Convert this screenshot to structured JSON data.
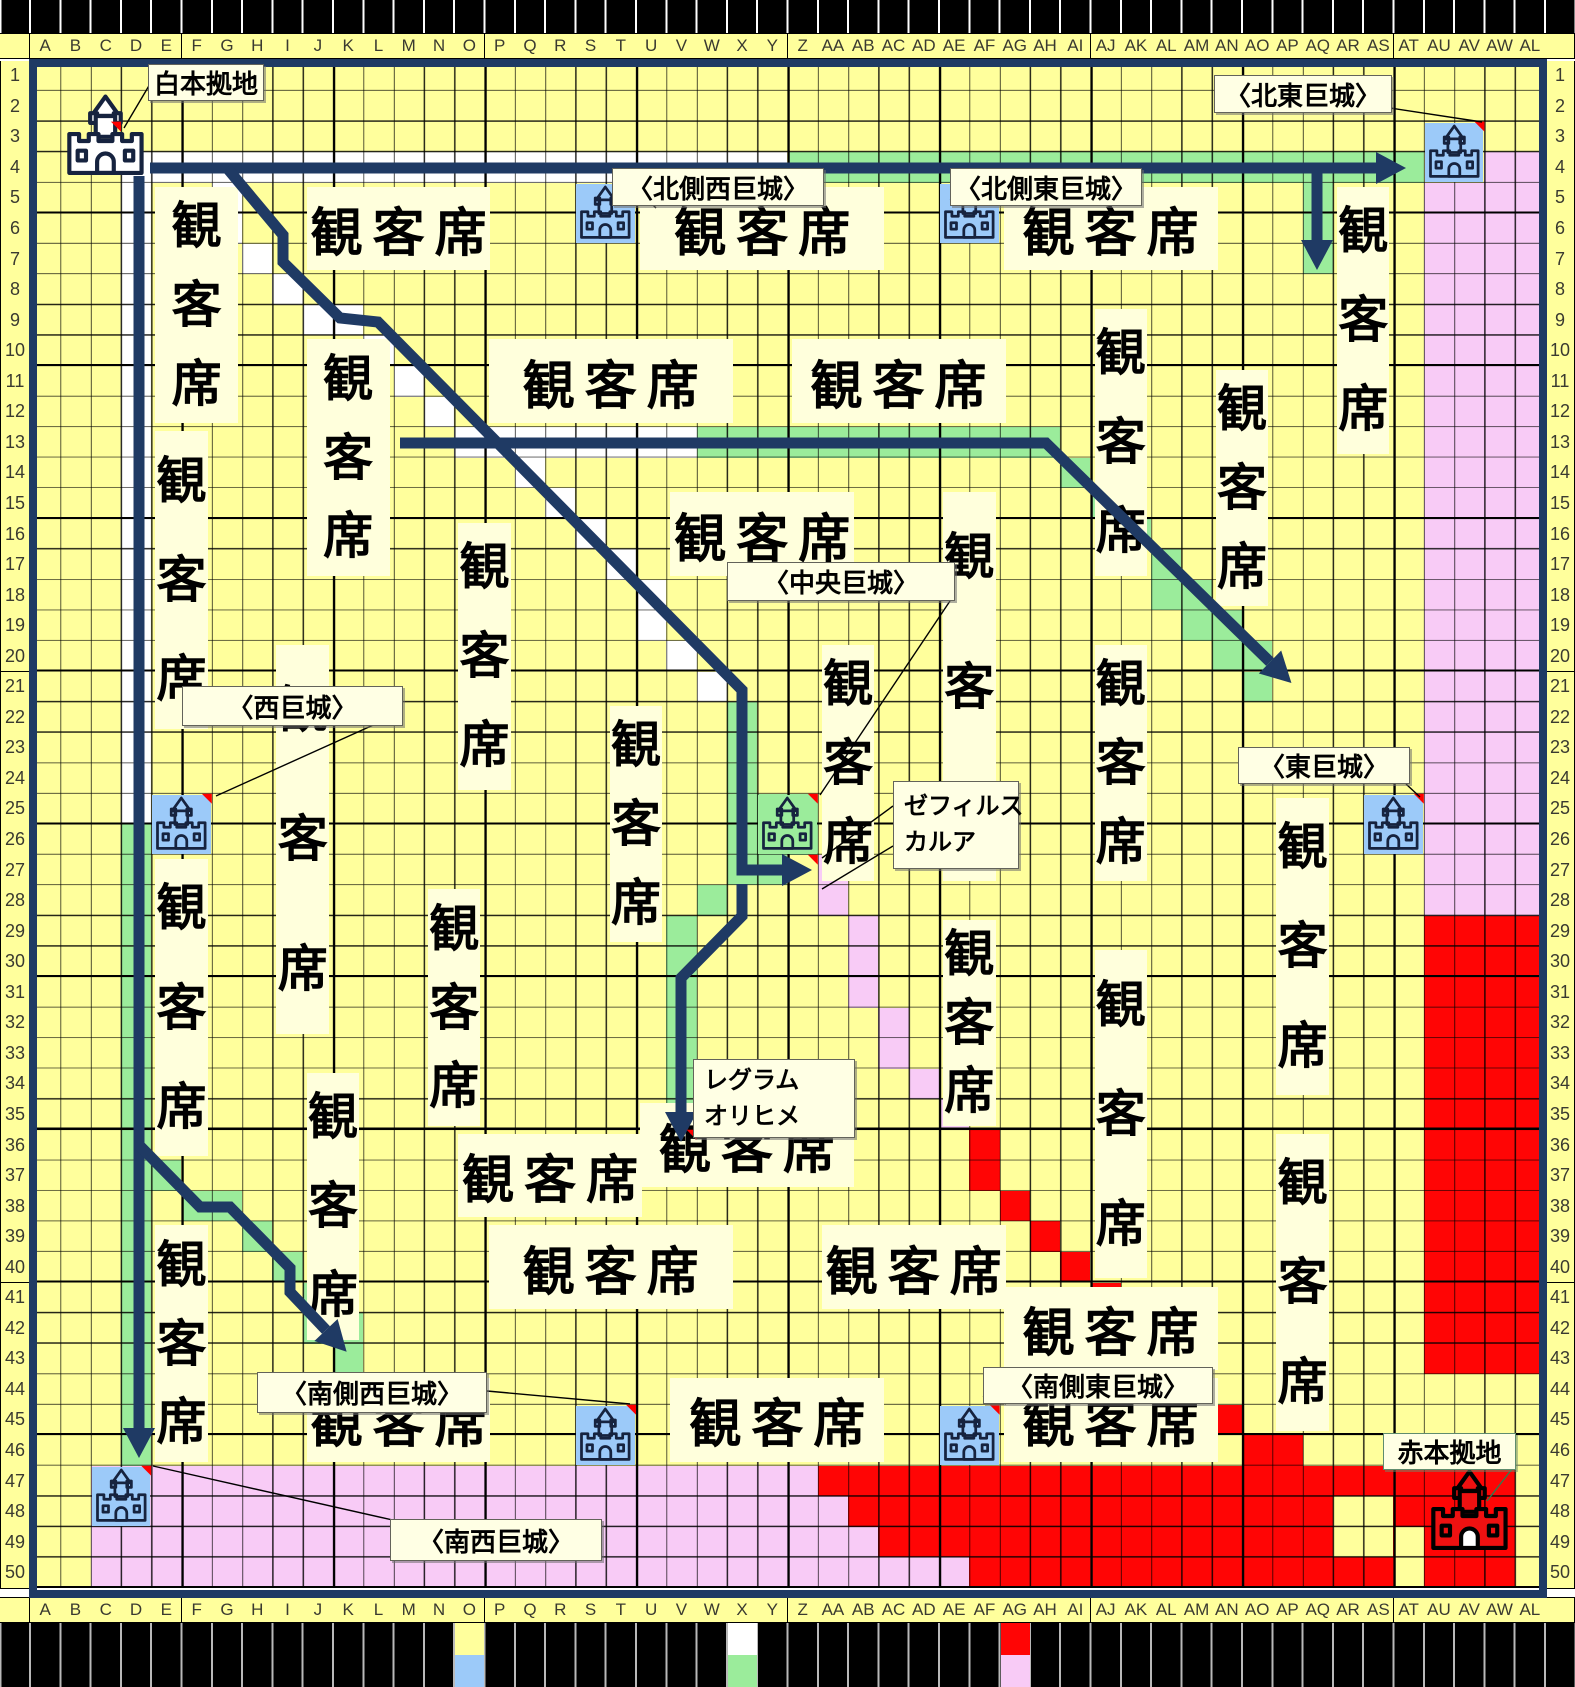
{
  "map_title": "合戦マップ(50×50)",
  "colors": {
    "yellow": "#FFFF9C",
    "white": "#FFFFFF",
    "green": "#9BEC9B",
    "pink": "#F8CBF6",
    "red": "#FF0505",
    "blue": "#9CCAF9",
    "cream": "#FFFFDC",
    "navy": "#1F3A64",
    "black": "#000000",
    "marker": "#FF0000",
    "pointer_green": "#2E7D4F"
  },
  "grid": {
    "origin_x": 30,
    "origin_y": 60.5,
    "cell_w": 30.3,
    "cell_h": 30.55,
    "col_count": 50,
    "row_count": 50,
    "col_headers": [
      "A",
      "B",
      "C",
      "D",
      "E",
      "F",
      "G",
      "H",
      "I",
      "J",
      "K",
      "L",
      "M",
      "N",
      "O",
      "P",
      "Q",
      "R",
      "S",
      "T",
      "U",
      "V",
      "W",
      "X",
      "Y",
      "Z",
      "AA",
      "AB",
      "AC",
      "AD",
      "AE",
      "AF",
      "AG",
      "AH",
      "AI",
      "AJ",
      "AK",
      "AL",
      "AM",
      "AN",
      "AO",
      "AP",
      "AQ",
      "AR",
      "AS",
      "AT",
      "AU",
      "AV",
      "AW",
      "AL"
    ],
    "row_numbers": [
      1,
      2,
      3,
      4,
      5,
      6,
      7,
      8,
      9,
      10,
      11,
      12,
      13,
      14,
      15,
      16,
      17,
      18,
      19,
      20,
      21,
      22,
      23,
      24,
      25,
      26,
      27,
      28,
      29,
      30,
      31,
      32,
      33,
      34,
      35,
      36,
      37,
      38,
      39,
      40,
      41,
      42,
      43,
      44,
      45,
      46,
      47,
      48,
      49,
      50
    ]
  },
  "regions": {
    "rects": [
      {
        "color": "pink",
        "c1": 46,
        "r1": 4,
        "c2": 49,
        "r2": 27
      },
      {
        "color": "pink",
        "c1": 48,
        "r1": 3,
        "c2": 49,
        "r2": 3
      },
      {
        "color": "red",
        "c1": 46,
        "r1": 28,
        "c2": 49,
        "r2": 42
      },
      {
        "color": "pink",
        "c1": 2,
        "r1": 46,
        "c2": 25,
        "r2": 49
      },
      {
        "color": "red",
        "c1": 26,
        "r1": 46,
        "c2": 48,
        "r2": 49
      },
      {
        "color": "white",
        "c1": 3,
        "r1": 3,
        "c2": 24,
        "r2": 3
      },
      {
        "color": "white",
        "c1": 3,
        "r1": 4,
        "c2": 3,
        "r2": 24
      },
      {
        "color": "white",
        "c1": 14,
        "r1": 12,
        "c2": 21,
        "r2": 12
      },
      {
        "color": "green",
        "c1": 25,
        "r1": 3,
        "c2": 45,
        "r2": 3
      },
      {
        "color": "green",
        "c1": 42,
        "r1": 4,
        "c2": 42,
        "r2": 6
      },
      {
        "color": "green",
        "c1": 22,
        "r1": 12,
        "c2": 33,
        "r2": 12
      },
      {
        "color": "green",
        "c1": 3,
        "r1": 25,
        "c2": 3,
        "r2": 45
      },
      {
        "color": "green",
        "c1": 23,
        "r1": 21,
        "c2": 23,
        "r2": 26
      },
      {
        "color": "green",
        "c1": 21,
        "r1": 28,
        "c2": 21,
        "r2": 35
      },
      {
        "color": "green",
        "c1": 24,
        "r1": 24,
        "c2": 25,
        "r2": 25
      }
    ],
    "cells": {
      "white": [
        [
          6,
          4
        ],
        [
          6,
          5
        ],
        [
          7,
          6
        ],
        [
          8,
          7
        ],
        [
          9,
          8
        ],
        [
          10,
          8
        ],
        [
          11,
          9
        ],
        [
          12,
          10
        ],
        [
          13,
          11
        ],
        [
          16,
          13
        ],
        [
          17,
          14
        ],
        [
          18,
          15
        ],
        [
          19,
          16
        ],
        [
          20,
          17
        ],
        [
          20,
          18
        ],
        [
          21,
          19
        ],
        [
          22,
          20
        ]
      ],
      "green": [
        [
          24,
          26
        ],
        [
          22,
          27
        ],
        [
          34,
          13
        ],
        [
          35,
          14
        ],
        [
          36,
          15
        ],
        [
          37,
          16
        ],
        [
          37,
          17
        ],
        [
          38,
          17
        ],
        [
          38,
          18
        ],
        [
          39,
          18
        ],
        [
          39,
          19
        ],
        [
          40,
          19
        ],
        [
          40,
          20
        ],
        [
          4,
          36
        ],
        [
          5,
          37
        ],
        [
          6,
          37
        ],
        [
          7,
          38
        ],
        [
          8,
          39
        ],
        [
          9,
          40
        ],
        [
          9,
          41
        ],
        [
          10,
          41
        ],
        [
          10,
          42
        ]
      ],
      "pink": [
        [
          26,
          26
        ],
        [
          26,
          27
        ],
        [
          27,
          28
        ],
        [
          27,
          29
        ],
        [
          27,
          30
        ],
        [
          28,
          31
        ],
        [
          28,
          32
        ],
        [
          29,
          33
        ],
        [
          30,
          34
        ],
        [
          26,
          47
        ],
        [
          26,
          48
        ],
        [
          27,
          48
        ],
        [
          26,
          49
        ],
        [
          27,
          49
        ],
        [
          28,
          49
        ],
        [
          29,
          49
        ],
        [
          30,
          49
        ]
      ],
      "red": [
        [
          31,
          35
        ],
        [
          31,
          36
        ],
        [
          32,
          37
        ],
        [
          33,
          38
        ],
        [
          34,
          39
        ],
        [
          35,
          40
        ],
        [
          36,
          41
        ],
        [
          37,
          42
        ],
        [
          38,
          43
        ],
        [
          39,
          44
        ],
        [
          40,
          45
        ],
        [
          41,
          45
        ],
        [
          42,
          46
        ]
      ],
      "yellow": [
        [
          43,
          47
        ],
        [
          44,
          47
        ],
        [
          43,
          48
        ],
        [
          44,
          48
        ],
        [
          45,
          48
        ],
        [
          45,
          49
        ],
        [
          49,
          46
        ],
        [
          49,
          47
        ],
        [
          49,
          48
        ],
        [
          49,
          49
        ]
      ]
    }
  },
  "spectator_blocks": {
    "text": "観客席",
    "blocks": [
      {
        "c1": 4,
        "r1": 4,
        "c2": 6,
        "r2": 11,
        "o": "v"
      },
      {
        "c1": 9,
        "r1": 4,
        "c2": 14,
        "r2": 6,
        "o": "h"
      },
      {
        "c1": 20,
        "r1": 4,
        "c2": 27,
        "r2": 6,
        "o": "h"
      },
      {
        "c1": 32,
        "r1": 4,
        "c2": 38,
        "r2": 6,
        "o": "h"
      },
      {
        "c1": 43,
        "r1": 4,
        "c2": 44,
        "r2": 12,
        "o": "v"
      },
      {
        "c1": 9,
        "r1": 9,
        "c2": 11,
        "r2": 16,
        "o": "v"
      },
      {
        "c1": 15,
        "r1": 9,
        "c2": 22,
        "r2": 11,
        "o": "h"
      },
      {
        "c1": 25,
        "r1": 9,
        "c2": 31,
        "r2": 11,
        "o": "h"
      },
      {
        "c1": 35,
        "r1": 8,
        "c2": 36,
        "r2": 16,
        "o": "v"
      },
      {
        "c1": 4,
        "r1": 12,
        "c2": 5,
        "r2": 21,
        "o": "v"
      },
      {
        "c1": 14,
        "r1": 15,
        "c2": 15,
        "r2": 23,
        "o": "v"
      },
      {
        "c1": 21,
        "r1": 14,
        "c2": 26,
        "r2": 16,
        "o": "h"
      },
      {
        "c1": 30,
        "r1": 14,
        "c2": 31,
        "r2": 26,
        "o": "v"
      },
      {
        "c1": 39,
        "r1": 10,
        "c2": 40,
        "r2": 17,
        "o": "v"
      },
      {
        "c1": 19,
        "r1": 21,
        "c2": 20,
        "r2": 28,
        "o": "v"
      },
      {
        "c1": 26,
        "r1": 19,
        "c2": 27,
        "r2": 26,
        "o": "v"
      },
      {
        "c1": 35,
        "r1": 19,
        "c2": 36,
        "r2": 26,
        "o": "v"
      },
      {
        "c1": 8,
        "r1": 19,
        "c2": 9,
        "r2": 31,
        "o": "v"
      },
      {
        "c1": 4,
        "r1": 26,
        "c2": 5,
        "r2": 35,
        "o": "v"
      },
      {
        "c1": 13,
        "r1": 27,
        "c2": 14,
        "r2": 34,
        "o": "v"
      },
      {
        "c1": 30,
        "r1": 28,
        "c2": 31,
        "r2": 34,
        "o": "v"
      },
      {
        "c1": 41,
        "r1": 24,
        "c2": 42,
        "r2": 33,
        "o": "v"
      },
      {
        "c1": 4,
        "r1": 38,
        "c2": 5,
        "r2": 45,
        "o": "v"
      },
      {
        "c1": 9,
        "r1": 33,
        "c2": 10,
        "r2": 41,
        "o": "v"
      },
      {
        "c1": 35,
        "r1": 29,
        "c2": 36,
        "r2": 39,
        "o": "v"
      },
      {
        "c1": 41,
        "r1": 35,
        "c2": 42,
        "r2": 44,
        "o": "v"
      },
      {
        "c1": 20,
        "r1": 34,
        "c2": 26,
        "r2": 36,
        "o": "h"
      },
      {
        "c1": 14,
        "r1": 35,
        "c2": 19,
        "r2": 37,
        "o": "h"
      },
      {
        "c1": 26,
        "r1": 38,
        "c2": 31,
        "r2": 40,
        "o": "h"
      },
      {
        "c1": 15,
        "r1": 38,
        "c2": 22,
        "r2": 40,
        "o": "h"
      },
      {
        "c1": 32,
        "r1": 40,
        "c2": 38,
        "r2": 42,
        "o": "h"
      },
      {
        "c1": 9,
        "r1": 43,
        "c2": 14,
        "r2": 45,
        "o": "h"
      },
      {
        "c1": 21,
        "r1": 43,
        "c2": 27,
        "r2": 45,
        "o": "h"
      },
      {
        "c1": 32,
        "r1": 43,
        "c2": 38,
        "r2": 45,
        "o": "h"
      }
    ]
  },
  "castles": [
    {
      "name": "white-home-base",
      "c": 1,
      "r": 1,
      "span": 3,
      "bg": null,
      "variant": "white"
    },
    {
      "name": "north-side-west-castle",
      "c": 18,
      "r": 4,
      "span": 2,
      "bg": "blue",
      "variant": "line"
    },
    {
      "name": "north-side-east-castle",
      "c": 30,
      "r": 4,
      "span": 2,
      "bg": "blue",
      "variant": "line"
    },
    {
      "name": "north-east-castle",
      "c": 46,
      "r": 2,
      "span": 2,
      "bg": "blue",
      "variant": "line"
    },
    {
      "name": "west-castle",
      "c": 4,
      "r": 24,
      "span": 2,
      "bg": "blue",
      "variant": "line"
    },
    {
      "name": "central-castle",
      "c": 24,
      "r": 24,
      "span": 2,
      "bg": "green",
      "variant": "line"
    },
    {
      "name": "east-castle",
      "c": 44,
      "r": 24,
      "span": 2,
      "bg": "blue",
      "variant": "line"
    },
    {
      "name": "south-west-castle",
      "c": 2,
      "r": 46,
      "span": 2,
      "bg": "blue",
      "variant": "line"
    },
    {
      "name": "south-side-west-castle",
      "c": 18,
      "r": 44,
      "span": 2,
      "bg": "blue",
      "variant": "line"
    },
    {
      "name": "south-side-east-castle",
      "c": 30,
      "r": 44,
      "span": 2,
      "bg": "blue",
      "variant": "line"
    },
    {
      "name": "red-home-base",
      "c": 46,
      "r": 46,
      "span": 3,
      "bg": null,
      "variant": "red"
    }
  ],
  "comment_markers": [
    [
      2,
      2
    ],
    [
      19,
      4
    ],
    [
      31,
      4
    ],
    [
      47,
      2
    ],
    [
      5,
      24
    ],
    [
      25,
      24
    ],
    [
      45,
      24
    ],
    [
      3,
      46
    ],
    [
      19,
      44
    ],
    [
      31,
      44
    ],
    [
      25,
      26
    ],
    [
      21,
      35
    ]
  ],
  "labels": [
    {
      "name": "label-white-home-base",
      "text": "白本拠地",
      "x": 148,
      "y": 64,
      "w": 116,
      "h": 37
    },
    {
      "name": "label-north-east-castle",
      "text": "〈北東巨城〉",
      "x": 1214,
      "y": 75,
      "w": 178,
      "h": 38
    },
    {
      "name": "label-north-side-west-castle",
      "text": "〈北側西巨城〉",
      "x": 612,
      "y": 168,
      "w": 212,
      "h": 38
    },
    {
      "name": "label-north-side-east-castle",
      "text": "〈北側東巨城〉",
      "x": 950,
      "y": 168,
      "w": 192,
      "h": 38
    },
    {
      "name": "label-west-castle",
      "text": "〈西巨城〉",
      "x": 182,
      "y": 686,
      "w": 221,
      "h": 40
    },
    {
      "name": "label-central-castle",
      "text": "〈中央巨城〉",
      "x": 727,
      "y": 562,
      "w": 228,
      "h": 39
    },
    {
      "name": "label-east-castle",
      "text": "〈東巨城〉",
      "x": 1238,
      "y": 747,
      "w": 172,
      "h": 37
    },
    {
      "name": "label-zephyrus-carua",
      "lines": [
        "ゼフィルス",
        "カルア"
      ],
      "x": 893,
      "y": 781,
      "w": 126,
      "h": 88
    },
    {
      "name": "label-regram-orihime",
      "lines": [
        "レグラム",
        "オリヒメ"
      ],
      "x": 693,
      "y": 1059,
      "w": 162,
      "h": 79
    },
    {
      "name": "label-south-side-west-castle",
      "text": "〈南側西巨城〉",
      "x": 257,
      "y": 1372,
      "w": 230,
      "h": 41
    },
    {
      "name": "label-south-side-east-castle",
      "text": "〈南側東巨城〉",
      "x": 983,
      "y": 1367,
      "w": 230,
      "h": 37
    },
    {
      "name": "label-south-west-castle",
      "text": "〈南西巨城〉",
      "x": 390,
      "y": 1519,
      "w": 212,
      "h": 42
    },
    {
      "name": "label-red-home-base",
      "text": "赤本拠地",
      "x": 1383,
      "y": 1433,
      "w": 133,
      "h": 37,
      "style": "green"
    }
  ],
  "pointer_lines": [
    {
      "pts": [
        [
          150,
          84
        ],
        [
          124,
          128
        ]
      ]
    },
    {
      "pts": [
        [
          1390,
          108
        ],
        [
          1482,
          122
        ]
      ]
    },
    {
      "pts": [
        [
          656,
          208
        ],
        [
          638,
          190
        ]
      ]
    },
    {
      "pts": [
        [
          950,
          200
        ],
        [
          1006,
          189
        ]
      ]
    },
    {
      "pts": [
        [
          380,
          722
        ],
        [
          216,
          796
        ]
      ]
    },
    {
      "pts": [
        [
          950,
          601
        ],
        [
          820,
          795
        ]
      ]
    },
    {
      "pts": [
        [
          1406,
          784
        ],
        [
          1420,
          797
        ]
      ]
    },
    {
      "pts": [
        [
          893,
          806
        ],
        [
          822,
          858
        ]
      ]
    },
    {
      "pts": [
        [
          893,
          846
        ],
        [
          822,
          889
        ]
      ]
    },
    {
      "pts": [
        [
          487,
          1391
        ],
        [
          630,
          1404
        ]
      ]
    },
    {
      "pts": [
        [
          983,
          1396
        ],
        [
          1006,
          1404
        ]
      ]
    },
    {
      "pts": [
        [
          397,
          1521
        ],
        [
          153,
          1466
        ]
      ]
    },
    {
      "pts": [
        [
          1512,
          1469
        ],
        [
          1487,
          1501
        ]
      ],
      "color": "green"
    }
  ],
  "route_arrows": [
    {
      "name": "white-route-east",
      "pts": [
        [
          150,
          168
        ],
        [
          1376,
          168
        ]
      ]
    },
    {
      "name": "route-branch-down-aq",
      "pts": [
        [
          1317,
          172
        ],
        [
          1317,
          240
        ]
      ]
    },
    {
      "name": "white-route-south",
      "pts": [
        [
          139,
          176
        ],
        [
          139,
          1428
        ]
      ]
    },
    {
      "name": "route-diagonal-to-central",
      "pts": [
        [
          227,
          168
        ],
        [
          283,
          235
        ],
        [
          283,
          262
        ],
        [
          340,
          318
        ],
        [
          378,
          322
        ],
        [
          742,
          690
        ],
        [
          742,
          870
        ],
        [
          782,
          870
        ]
      ]
    },
    {
      "name": "green-route-row13-east",
      "pts": [
        [
          400,
          443
        ],
        [
          1046,
          443
        ],
        [
          1270,
          662
        ]
      ]
    },
    {
      "name": "route-central-down",
      "pts": [
        [
          742,
          884
        ],
        [
          742,
          916
        ],
        [
          681,
          978
        ],
        [
          681,
          1112
        ]
      ]
    },
    {
      "name": "route-southwest-branch",
      "pts": [
        [
          139,
          1145
        ],
        [
          200,
          1207
        ],
        [
          230,
          1207
        ],
        [
          290,
          1268
        ],
        [
          290,
          1292
        ],
        [
          326,
          1330
        ]
      ]
    }
  ],
  "legend": {
    "rows": [
      {
        "swatches": [
          {
            "col": 14,
            "color": "yellow"
          },
          {
            "col": 23,
            "color": "white"
          },
          {
            "col": 32,
            "color": "red"
          }
        ]
      },
      {
        "swatches": [
          {
            "col": 14,
            "color": "blue"
          },
          {
            "col": 23,
            "color": "green"
          },
          {
            "col": 32,
            "color": "pink"
          }
        ]
      }
    ]
  }
}
